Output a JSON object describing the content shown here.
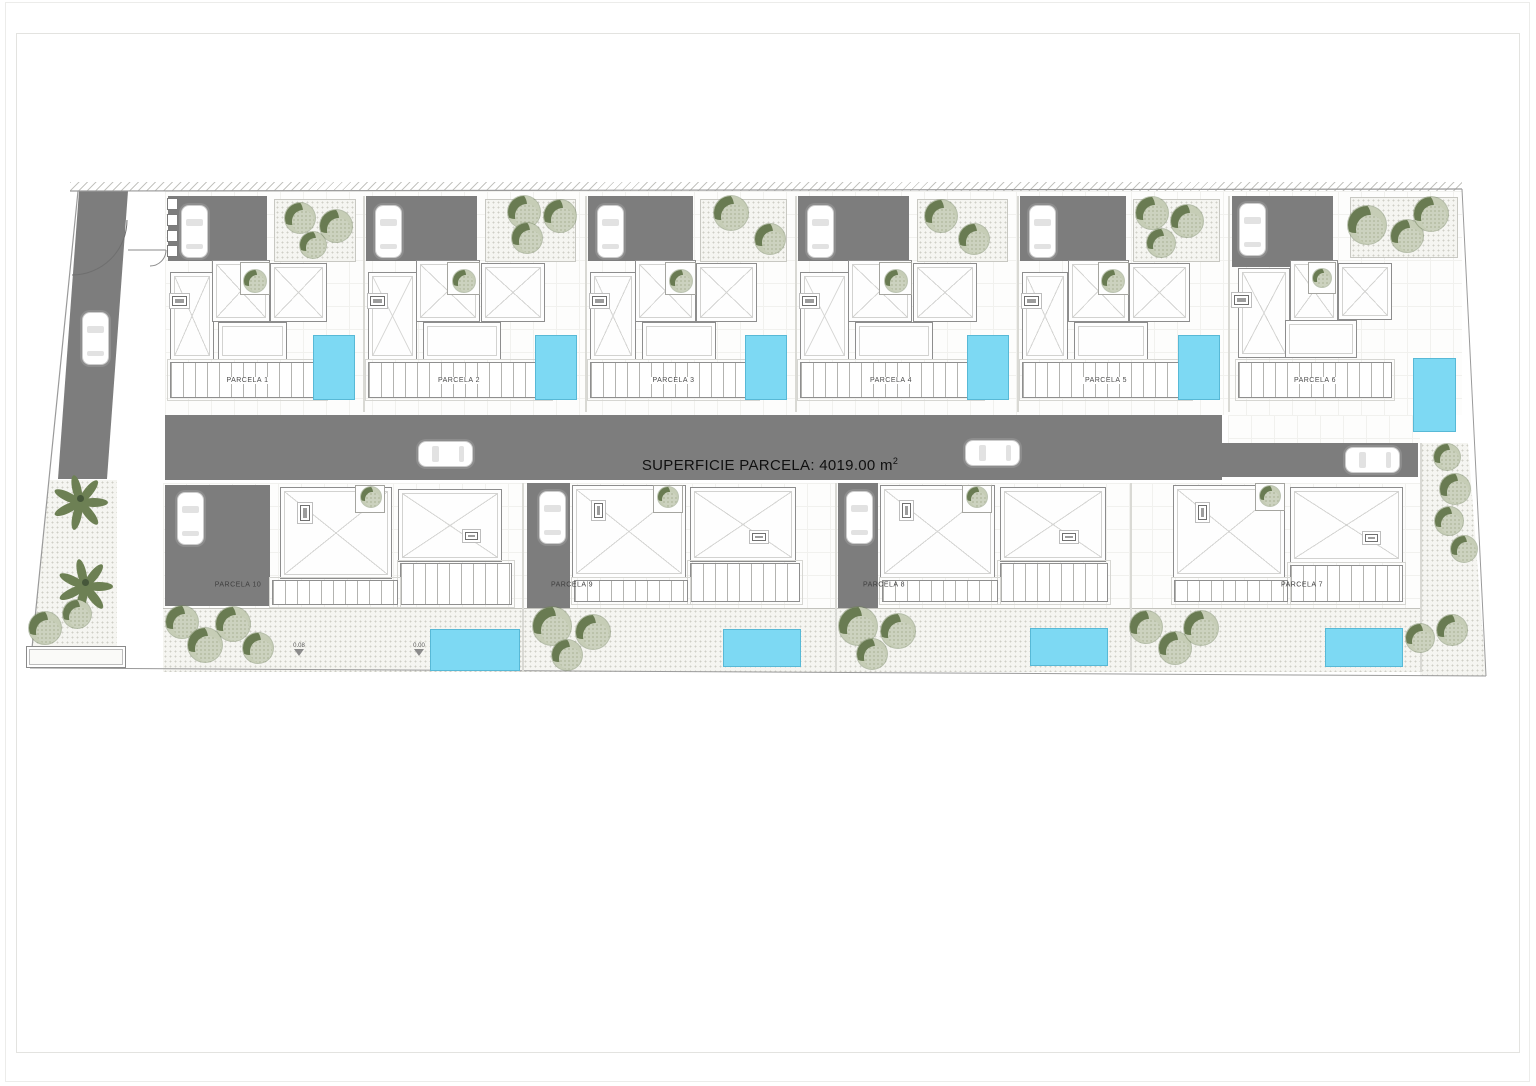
{
  "road": {
    "label": "SUPERFICIE PARCELA: 4019.00 m",
    "sup": "2"
  },
  "annotations": {
    "levels": [
      "0.08",
      "0.00"
    ]
  },
  "plan": {
    "top": [
      {
        "label": "PARCELA 1",
        "drive": [
          168,
          196,
          99,
          65
        ],
        "garden": [
          274,
          199,
          82,
          63
        ],
        "roofA": [
          170,
          272,
          44,
          88
        ],
        "roofB": [
          212,
          260,
          58,
          62
        ],
        "notch": [
          240,
          262,
          30,
          33
        ],
        "roofC": [
          270,
          263,
          57,
          59
        ],
        "terrace": [
          218,
          322,
          69,
          38
        ],
        "skyA": [
          172,
          296,
          15,
          10
        ],
        "deck": [
          170,
          362,
          155,
          36
        ],
        "pool": [
          313,
          335,
          42,
          65
        ],
        "ntree": [
          255,
          281,
          11
        ],
        "car": [
          181,
          205
        ],
        "gtrees": [
          [
            300,
            218,
            15
          ],
          [
            336,
            226,
            16
          ],
          [
            313,
            245,
            13
          ]
        ]
      },
      {
        "label": "PARCELA 2",
        "drive": [
          366,
          196,
          111,
          65
        ],
        "garden": [
          485,
          199,
          91,
          63
        ],
        "roofA": [
          368,
          272,
          49,
          88
        ],
        "roofB": [
          416,
          260,
          64,
          62
        ],
        "notch": [
          447,
          262,
          33,
          33
        ],
        "roofC": [
          481,
          263,
          64,
          59
        ],
        "terrace": [
          423,
          322,
          78,
          38
        ],
        "skyA": [
          370,
          296,
          15,
          10
        ],
        "deck": [
          368,
          362,
          182,
          36
        ],
        "pool": [
          535,
          335,
          42,
          65
        ],
        "ntree": [
          464,
          281,
          11
        ],
        "car": [
          375,
          205
        ],
        "gtrees": [
          [
            524,
            212,
            16
          ],
          [
            560,
            216,
            16
          ],
          [
            527,
            238,
            15
          ]
        ]
      },
      {
        "label": "PARCELA 3",
        "drive": [
          588,
          196,
          105,
          65
        ],
        "garden": [
          700,
          199,
          87,
          63
        ],
        "roofA": [
          590,
          272,
          46,
          88
        ],
        "roofB": [
          635,
          260,
          61,
          62
        ],
        "notch": [
          665,
          262,
          31,
          33
        ],
        "roofC": [
          696,
          263,
          61,
          59
        ],
        "terrace": [
          642,
          322,
          74,
          38
        ],
        "skyA": [
          592,
          296,
          15,
          10
        ],
        "deck": [
          590,
          362,
          167,
          36
        ],
        "pool": [
          745,
          335,
          42,
          65
        ],
        "ntree": [
          681,
          281,
          11
        ],
        "car": [
          597,
          205
        ],
        "gtrees": [
          [
            731,
            213,
            17
          ],
          [
            770,
            239,
            15
          ]
        ]
      },
      {
        "label": "PARCELA 4",
        "drive": [
          798,
          196,
          111,
          65
        ],
        "garden": [
          917,
          199,
          91,
          63
        ],
        "roofA": [
          800,
          272,
          49,
          88
        ],
        "roofB": [
          848,
          260,
          64,
          62
        ],
        "notch": [
          879,
          262,
          33,
          33
        ],
        "roofC": [
          913,
          263,
          64,
          59
        ],
        "terrace": [
          855,
          322,
          78,
          38
        ],
        "skyA": [
          802,
          296,
          15,
          10
        ],
        "deck": [
          800,
          362,
          182,
          36
        ],
        "pool": [
          967,
          335,
          42,
          65
        ],
        "ntree": [
          896,
          281,
          11
        ],
        "car": [
          807,
          205
        ],
        "gtrees": [
          [
            941,
            216,
            16
          ],
          [
            974,
            239,
            15
          ]
        ]
      },
      {
        "label": "PARCELA 5",
        "drive": [
          1020,
          196,
          106,
          65
        ],
        "garden": [
          1133,
          199,
          87,
          63
        ],
        "roofA": [
          1022,
          272,
          46,
          88
        ],
        "roofB": [
          1068,
          260,
          61,
          62
        ],
        "notch": [
          1098,
          262,
          31,
          33
        ],
        "roofC": [
          1129,
          263,
          61,
          59
        ],
        "terrace": [
          1074,
          322,
          74,
          38
        ],
        "skyA": [
          1024,
          296,
          15,
          10
        ],
        "deck": [
          1022,
          362,
          168,
          36
        ],
        "pool": [
          1178,
          335,
          42,
          65
        ],
        "ntree": [
          1113,
          281,
          11
        ],
        "car": [
          1029,
          205
        ],
        "gtrees": [
          [
            1152,
            213,
            16
          ],
          [
            1187,
            221,
            16
          ],
          [
            1161,
            243,
            14
          ]
        ]
      },
      {
        "label": "PARCELA 6",
        "drive": [
          1232,
          196,
          101,
          71
        ],
        "garden": [
          1350,
          197,
          108,
          61
        ],
        "roofA": [
          1238,
          268,
          52,
          90
        ],
        "roofB": [
          1290,
          260,
          48,
          62
        ],
        "notch": [
          1308,
          262,
          28,
          32
        ],
        "roofC": [
          1338,
          263,
          54,
          57
        ],
        "terrace": [
          1285,
          320,
          72,
          38
        ],
        "skyA": [
          1234,
          295,
          15,
          10
        ],
        "deck": [
          1238,
          362,
          154,
          36
        ],
        "pool": [
          1413,
          358,
          43,
          74
        ],
        "ntree": [
          1322,
          278,
          9
        ],
        "car": [
          1239,
          203
        ],
        "gtrees": [
          [
            1367,
            225,
            19
          ],
          [
            1407,
            236,
            16
          ],
          [
            1431,
            214,
            17
          ]
        ]
      }
    ],
    "bottom": [
      {
        "label": "PARCELA 10",
        "label_pos": [
          238,
          585
        ],
        "drive": [
          165,
          485,
          105,
          121
        ],
        "car": [
          177,
          492
        ],
        "roofL": [
          280,
          487,
          112,
          92
        ],
        "skyL": [
          300,
          505,
          10,
          16
        ],
        "notch": [
          355,
          485,
          30,
          28
        ],
        "ntree": [
          371,
          497,
          10
        ],
        "roofR": [
          398,
          489,
          104,
          73
        ],
        "skyR": [
          465,
          532,
          13,
          8
        ],
        "pergV": [
          400,
          563,
          112,
          42
        ],
        "pergH": [
          272,
          580,
          126,
          25
        ],
        "pool": [
          430,
          629,
          90,
          42
        ],
        "trees": [
          [
            182,
            622,
            16
          ],
          [
            205,
            645,
            17
          ],
          [
            233,
            624,
            17
          ],
          [
            258,
            648,
            15
          ]
        ]
      },
      {
        "label": "PARCELA 9",
        "label_pos": [
          572,
          585
        ],
        "drive": [
          527,
          483,
          43,
          125
        ],
        "car": [
          539,
          491
        ],
        "roofL": [
          572,
          485,
          114,
          93
        ],
        "skyL": [
          594,
          503,
          9,
          15
        ],
        "notch": [
          653,
          485,
          30,
          28
        ],
        "ntree": [
          668,
          497,
          10
        ],
        "roofR": [
          690,
          487,
          106,
          75
        ],
        "skyR": [
          752,
          533,
          14,
          8
        ],
        "pergV": [
          690,
          563,
          110,
          39
        ],
        "pergH": [
          574,
          580,
          114,
          22
        ],
        "pool": [
          723,
          629,
          78,
          38
        ],
        "trees": [
          [
            552,
            626,
            19
          ],
          [
            593,
            632,
            17
          ],
          [
            567,
            655,
            15
          ]
        ]
      },
      {
        "label": "PARCELA 8",
        "label_pos": [
          884,
          585
        ],
        "drive": [
          838,
          483,
          40,
          125
        ],
        "car": [
          846,
          491
        ],
        "roofL": [
          880,
          485,
          115,
          93
        ],
        "skyL": [
          902,
          503,
          9,
          15
        ],
        "notch": [
          962,
          485,
          30,
          28
        ],
        "ntree": [
          977,
          497,
          10
        ],
        "roofR": [
          1000,
          487,
          106,
          75
        ],
        "skyR": [
          1062,
          533,
          14,
          8
        ],
        "pergV": [
          1000,
          563,
          108,
          39
        ],
        "pergH": [
          882,
          580,
          116,
          22
        ],
        "pool": [
          1030,
          628,
          78,
          38
        ],
        "trees": [
          [
            858,
            626,
            19
          ],
          [
            898,
            631,
            17
          ],
          [
            872,
            654,
            15
          ]
        ]
      },
      {
        "label": "PARCELA 7",
        "label_pos": [
          1302,
          585
        ],
        "roofL": [
          1173,
          485,
          112,
          93
        ],
        "skyL": [
          1198,
          505,
          9,
          15
        ],
        "notch": [
          1255,
          483,
          30,
          28
        ],
        "ntree": [
          1270,
          496,
          10
        ],
        "roofR": [
          1290,
          487,
          113,
          76
        ],
        "skyR": [
          1365,
          534,
          13,
          8
        ],
        "pergV": [
          1290,
          565,
          113,
          37
        ],
        "pergH": [
          1174,
          580,
          114,
          22
        ],
        "pool": [
          1325,
          628,
          78,
          39
        ],
        "trees": [
          [
            1146,
            627,
            16
          ],
          [
            1175,
            648,
            16
          ],
          [
            1201,
            628,
            17
          ]
        ]
      }
    ],
    "cars_road": [
      [
        418,
        441
      ],
      [
        965,
        440
      ],
      [
        1345,
        447
      ]
    ],
    "car_left": [
      82,
      312
    ],
    "palms": [
      [
        80,
        498,
        24
      ],
      [
        85,
        582,
        24
      ]
    ],
    "trees_extra": [
      [
        45,
        628,
        16
      ],
      [
        77,
        614,
        14
      ],
      [
        1447,
        457,
        13
      ],
      [
        1455,
        489,
        15
      ],
      [
        1449,
        521,
        14
      ],
      [
        1464,
        549,
        13
      ],
      [
        1420,
        638,
        14
      ],
      [
        1452,
        630,
        15
      ]
    ],
    "posts": [
      198,
      214,
      230,
      245
    ],
    "seps_top": [
      363,
      585,
      795,
      1017,
      1228
    ],
    "seps_bottom": [
      522,
      835,
      1130
    ]
  }
}
